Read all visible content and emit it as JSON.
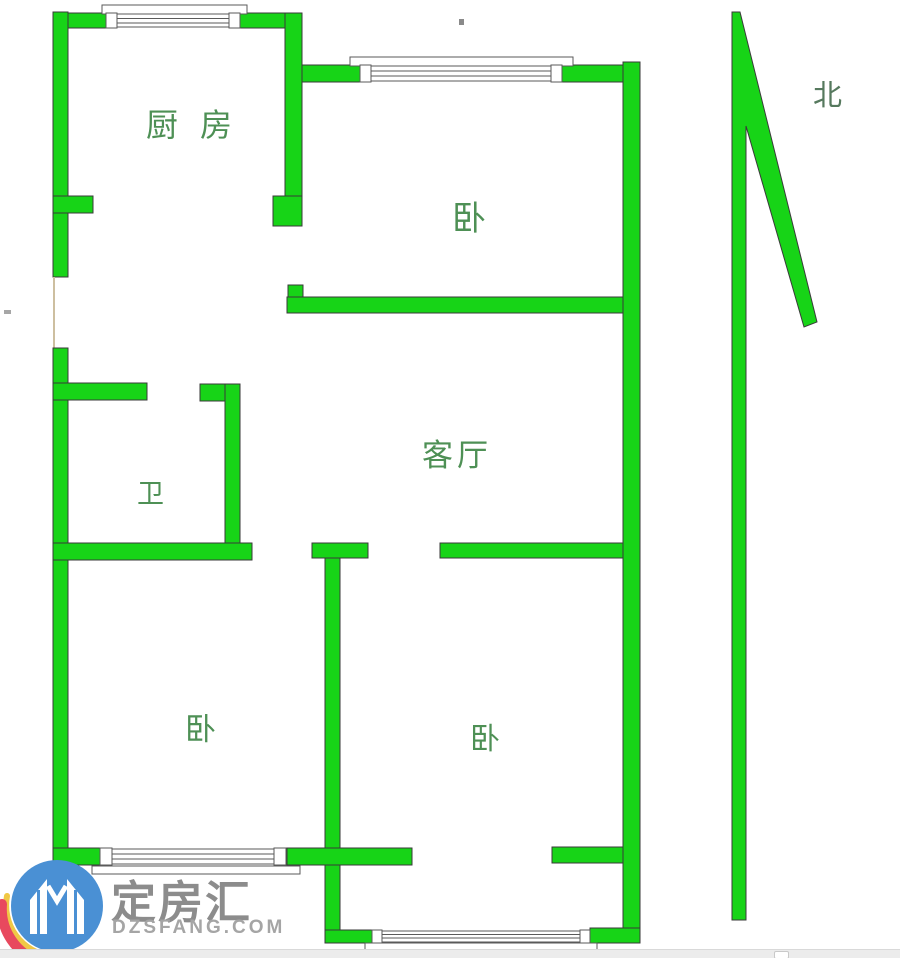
{
  "floor_plan": {
    "rooms": [
      {
        "id": "kitchen",
        "label": "厨房"
      },
      {
        "id": "bedroom-top-right",
        "label": "卧"
      },
      {
        "id": "living-room",
        "label": "客厅"
      },
      {
        "id": "bathroom",
        "label": "卫"
      },
      {
        "id": "bedroom-bottom-left",
        "label": "卧"
      },
      {
        "id": "bedroom-bottom-right",
        "label": "卧"
      }
    ],
    "compass": {
      "label": "北"
    },
    "colors": {
      "wall": "#17d417",
      "wall_outline": "#3a3a3a",
      "room_label": "#4e9055",
      "compass_label": "#56795e",
      "window_line": "#5a5a5a",
      "door_gap_line": "#cdbfa0"
    }
  },
  "watermark": {
    "brand_name": "定房汇",
    "brand_domain": "DZSFANG.COM",
    "colors": {
      "logo_blue": "#4a90d4",
      "logo_red": "#e8495e",
      "logo_yellow": "#f0c845",
      "brand_text": "#8c8c8c",
      "domain_text": "#a5a5a5"
    }
  }
}
